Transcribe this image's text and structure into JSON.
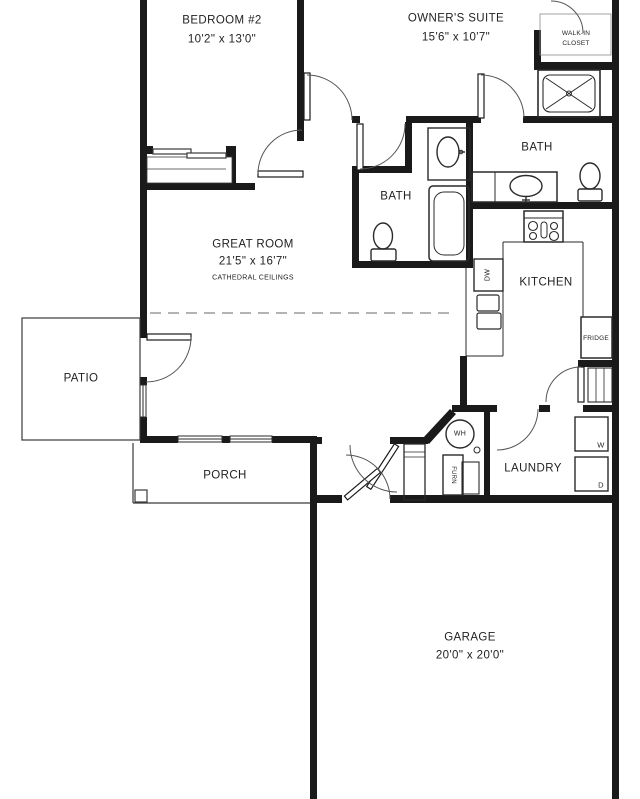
{
  "drawing_title": "Floor Plan",
  "colors": {
    "background": "#ffffff",
    "walls": "#1a1a1a",
    "thin_lines": "#3a3a3a",
    "door_arcs": "#555555",
    "dashed_line": "#9a9a9a",
    "text": "#222222"
  },
  "rooms": {
    "bedroom2": {
      "name": "BEDROOM #2",
      "dims": "10'2\" x 13'0\""
    },
    "owners_suite": {
      "name": "OWNER'S SUITE",
      "dims": "15'6\" x 10'7\""
    },
    "walkin_closet": {
      "line1": "WALK-IN",
      "line2": "CLOSET"
    },
    "bath_owner": {
      "name": "BATH"
    },
    "bath_hall": {
      "name": "BATH"
    },
    "great_room": {
      "name": "GREAT ROOM",
      "dims": "21'5\" x 16'7\"",
      "note": "CATHEDRAL CEILINGS"
    },
    "kitchen": {
      "name": "KITCHEN"
    },
    "patio": {
      "name": "PATIO"
    },
    "porch": {
      "name": "PORCH"
    },
    "laundry": {
      "name": "LAUNDRY"
    },
    "garage": {
      "name": "GARAGE",
      "dims": "20'0\" x 20'0\""
    }
  },
  "appliances": {
    "dishwasher": "DW",
    "fridge": "FRIDGE",
    "water_heater": "WH",
    "furnace": "FURN",
    "washer": "W",
    "dryer": "D"
  }
}
